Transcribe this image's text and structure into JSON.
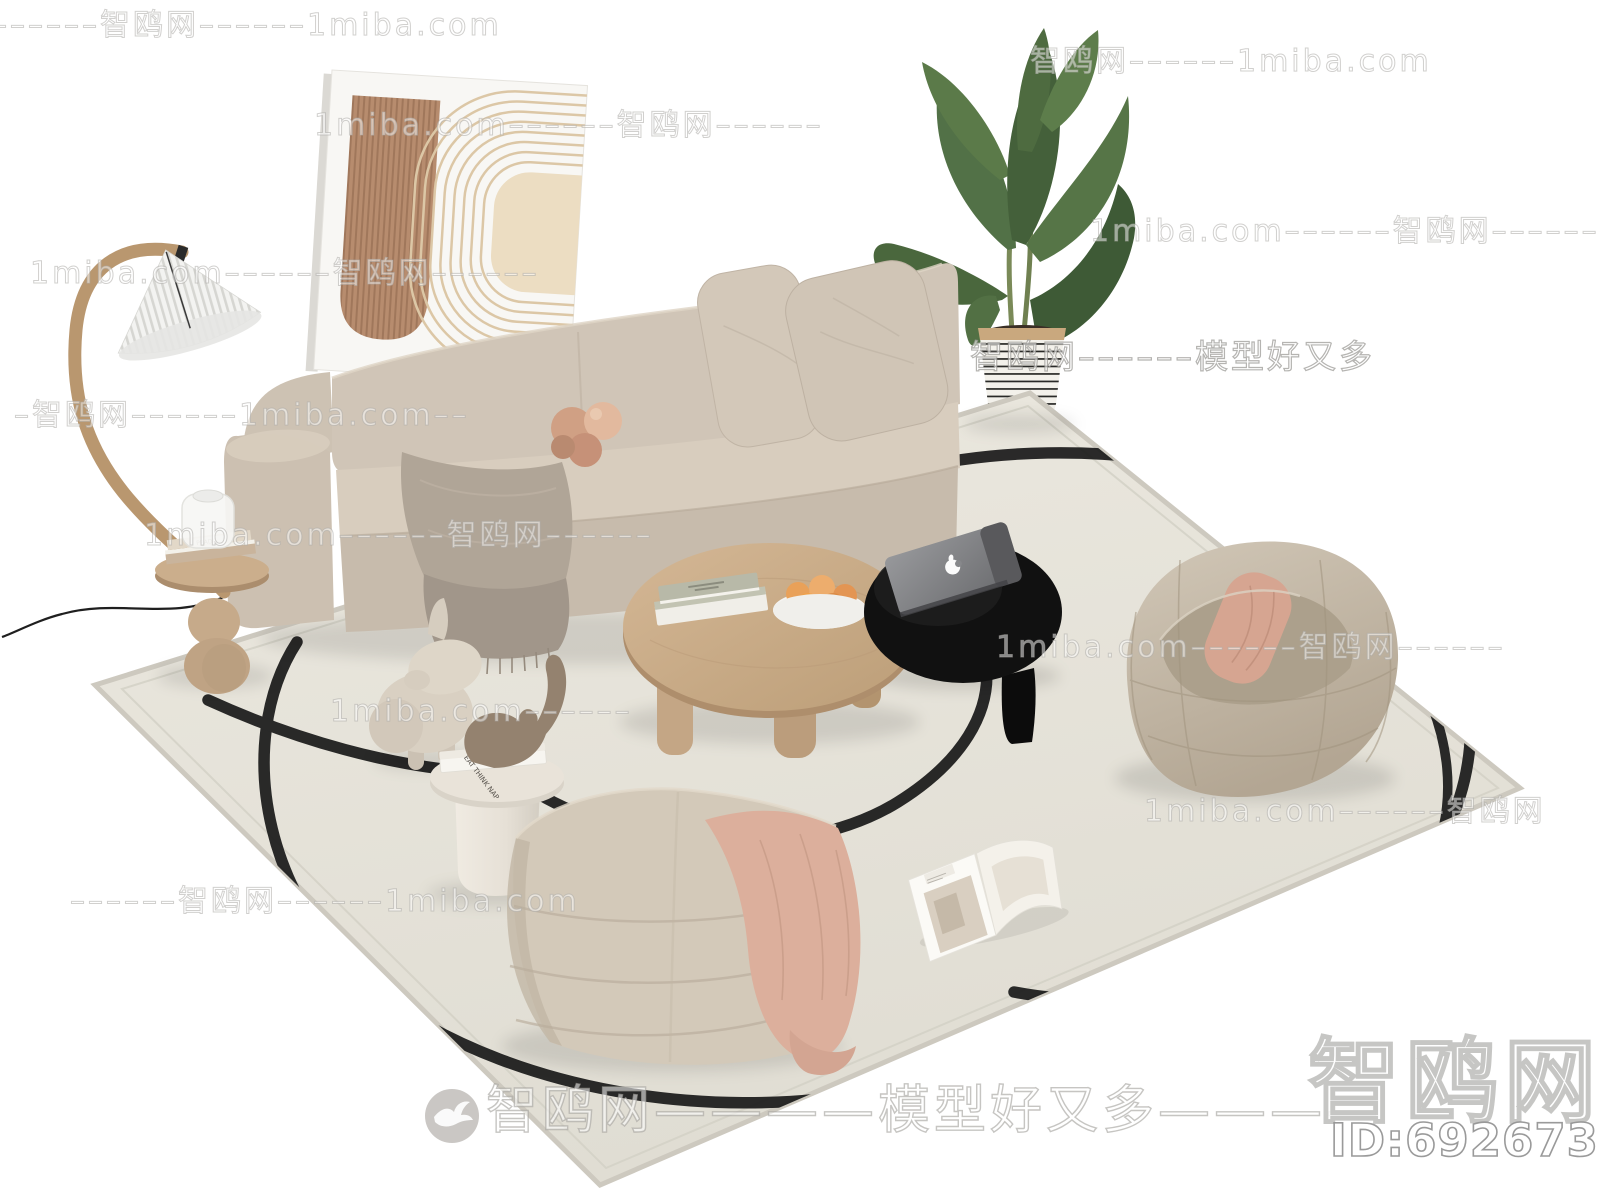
{
  "site": {
    "name": "智鸥网",
    "domain": "1miba.com",
    "tagline": "模型好又多"
  },
  "watermarks": {
    "rows": [
      {
        "x": -8,
        "y": 0,
        "text": "––––––智鸥网––––––1miba.com"
      },
      {
        "x": 1030,
        "y": 36,
        "text": "智鸥网––––––1miba.com"
      },
      {
        "x": 314,
        "y": 100,
        "text": "1miba.com––––––智鸥网––––––"
      },
      {
        "x": 1090,
        "y": 206,
        "text": "1miba.com––––––智鸥网––––––"
      },
      {
        "x": 30,
        "y": 248,
        "text": "1miba.com––––––智鸥网––––––"
      },
      {
        "x": 970,
        "y": 330,
        "text": "智鸥网––––––模型好又多",
        "strong": true
      },
      {
        "x": 14,
        "y": 390,
        "text": "–智鸥网––––––1miba.com––"
      },
      {
        "x": 144,
        "y": 510,
        "text": "1miba.com––––––智鸥网––––––"
      },
      {
        "x": 996,
        "y": 622,
        "text": "1miba.com––––––智鸥网––––––"
      },
      {
        "x": 330,
        "y": 694,
        "text": "1miba.com––––––"
      },
      {
        "x": 1144,
        "y": 786,
        "text": "1miba.com––––––智鸥网"
      },
      {
        "x": 70,
        "y": 876,
        "text": "––––––智鸥网––––––1miba.com"
      }
    ],
    "footer_text": "智鸥网————模型好又多————",
    "logo_text": "智鸥网",
    "model_id": "ID:692673929"
  },
  "scene": {
    "lamp_table_book_label": "PRADA",
    "side_table_book_label": "EAT THINK NAP",
    "colors": {
      "background": "#ffffff",
      "rug": "#e7e4db",
      "rug_edge": "#d2cfc5",
      "squiggle": "#191919",
      "sofa": "#d0c5b7",
      "throw_blanket": "#aba093",
      "knot_pillow": "#d0a084",
      "wood": "#c8ab88",
      "black_table": "#111111",
      "laptop": "#8a8b8e",
      "bean_bag": "#c6bbaa",
      "pink_pillow": "#d6a591",
      "lounge_chair": "#d3c9b9",
      "daisy_center": "#f1a43d",
      "plant_green": "#4e6b40",
      "art_brown": "#b78c6e",
      "art_cream": "#ecddc2"
    }
  }
}
